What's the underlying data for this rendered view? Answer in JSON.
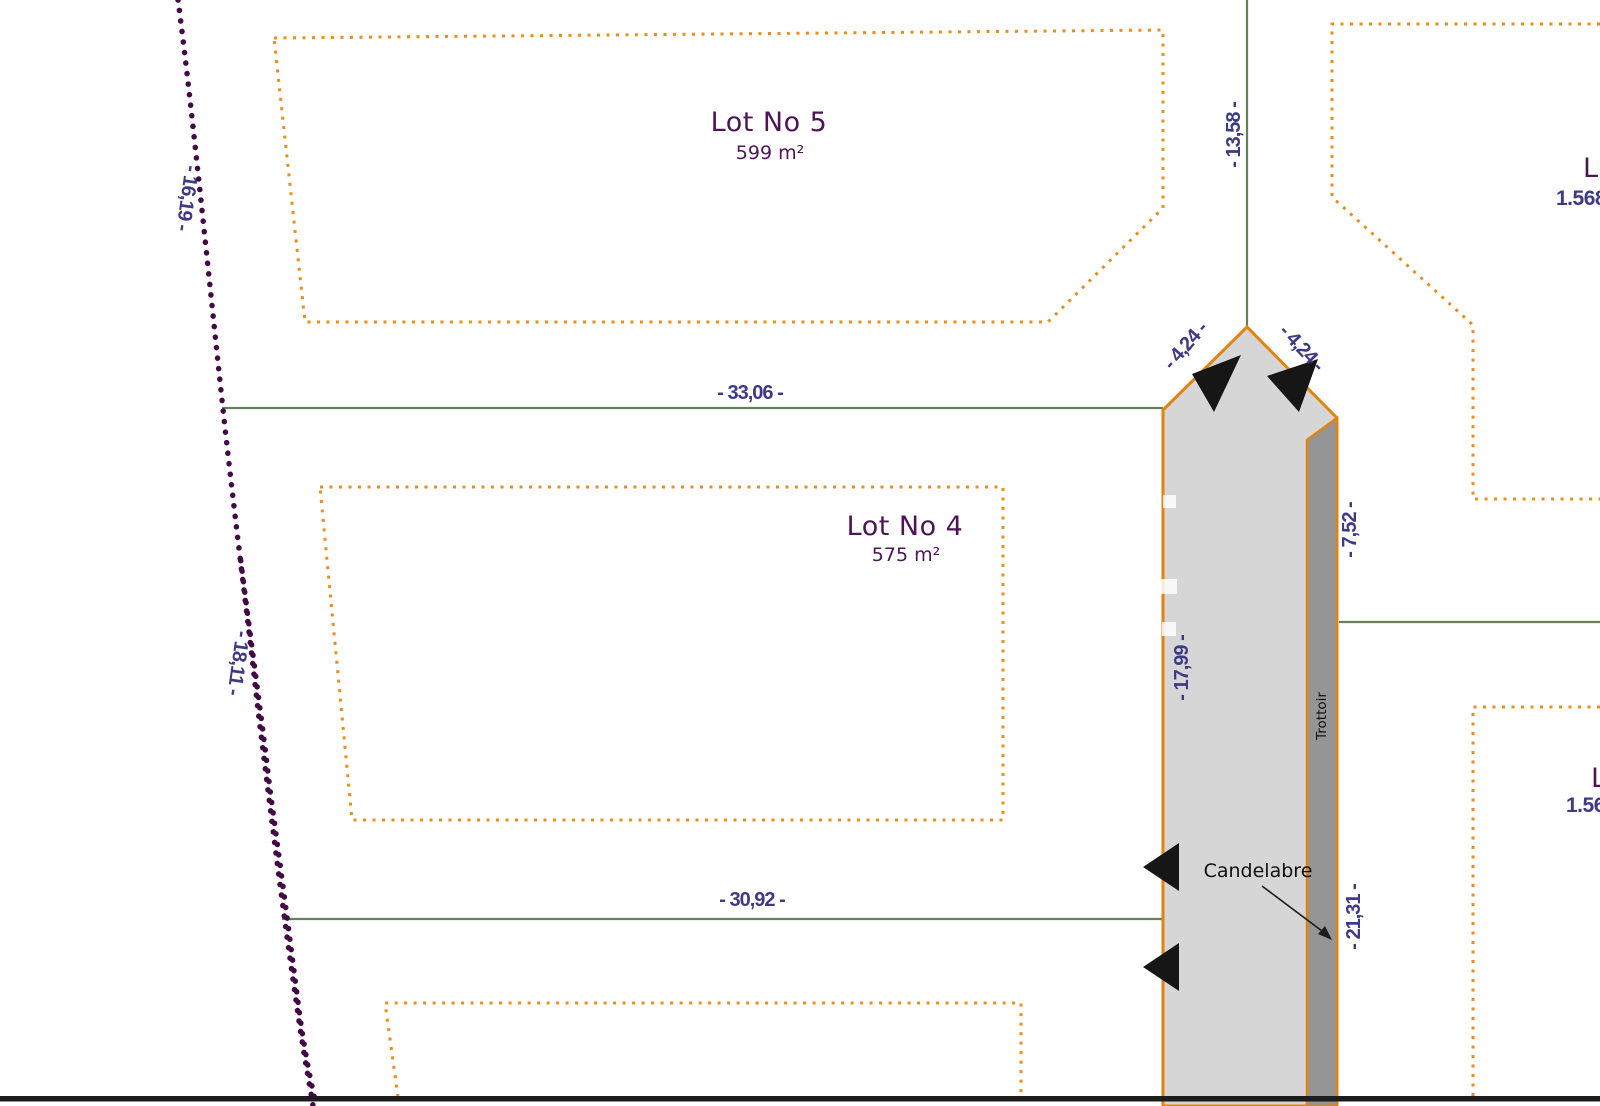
{
  "plan": {
    "lots": [
      {
        "name": "Lot No 5",
        "area": "599 m²"
      },
      {
        "name": "Lot No 4",
        "area": "575 m²"
      },
      {
        "name": "L",
        "area": "1.568"
      },
      {
        "name": "L",
        "area": "1.56"
      }
    ],
    "dimensions": {
      "road_axis_top": "- 13,58 -",
      "lot5_south": "- 33,06 -",
      "lot4_south": "- 30,92 -",
      "apex_left": "- 4,24 -",
      "apex_right": "- 4,24 -",
      "road_left_edge": "- 17,99 -",
      "sidewalk_upper": "- 7,52 -",
      "sidewalk_lower": "- 21,31 -",
      "west_boundary_upper": "- 16,19 -",
      "west_boundary_lower": "- 18,11 -"
    },
    "labels": {
      "candelabre": "Candelabre",
      "trottoir": "Trottoir"
    },
    "colors": {
      "orange": "#ec8c1c",
      "roadBorder": "#e2830f",
      "green": "#66805a",
      "dimText": "#3d3a86",
      "lotText": "#4d1456",
      "purpleDot": "#410a44",
      "roadFill": "#d6d6d6",
      "sidewalkFill": "#959595",
      "ink": "#141414"
    }
  }
}
